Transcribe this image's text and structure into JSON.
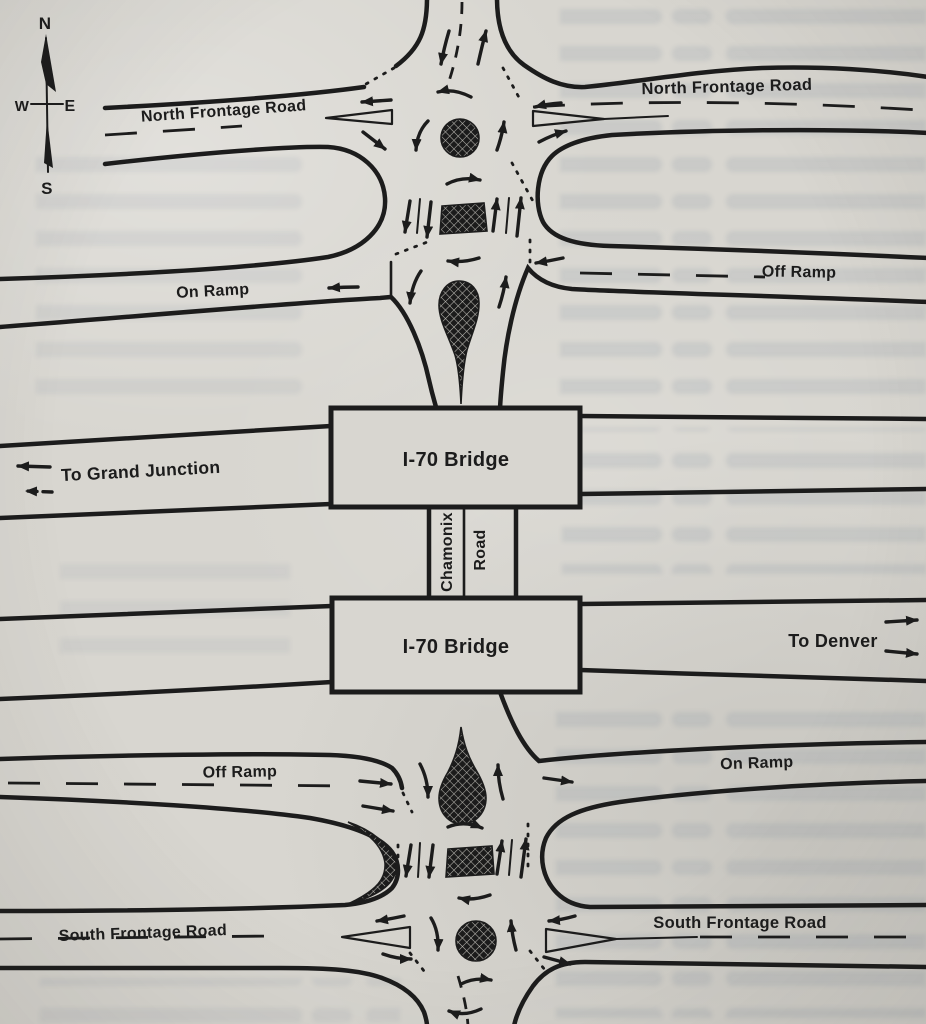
{
  "title": "I-70 / Chamonix Road interchange diagram",
  "compass": {
    "north": "N",
    "south": "S",
    "west": "W",
    "east": "E"
  },
  "labels": {
    "north_frontage_left": "North Frontage Road",
    "north_frontage_right": "North Frontage Road",
    "on_ramp_upper_left": "On Ramp",
    "off_ramp_upper_right": "Off Ramp",
    "to_grand_junction": "To Grand Junction",
    "i70_bridge_upper": "I-70 Bridge",
    "i70_bridge_lower": "I-70 Bridge",
    "chamonix": "Chamonix",
    "chamonix_road_word": "Road",
    "to_denver": "To Denver",
    "off_ramp_lower_left": "Off Ramp",
    "on_ramp_lower_right": "On Ramp",
    "south_frontage_left": "South Frontage Road",
    "south_frontage_right": "South Frontage Road"
  },
  "colors": {
    "paper": "#d8d6d0",
    "ink": "#1c1c1c"
  }
}
